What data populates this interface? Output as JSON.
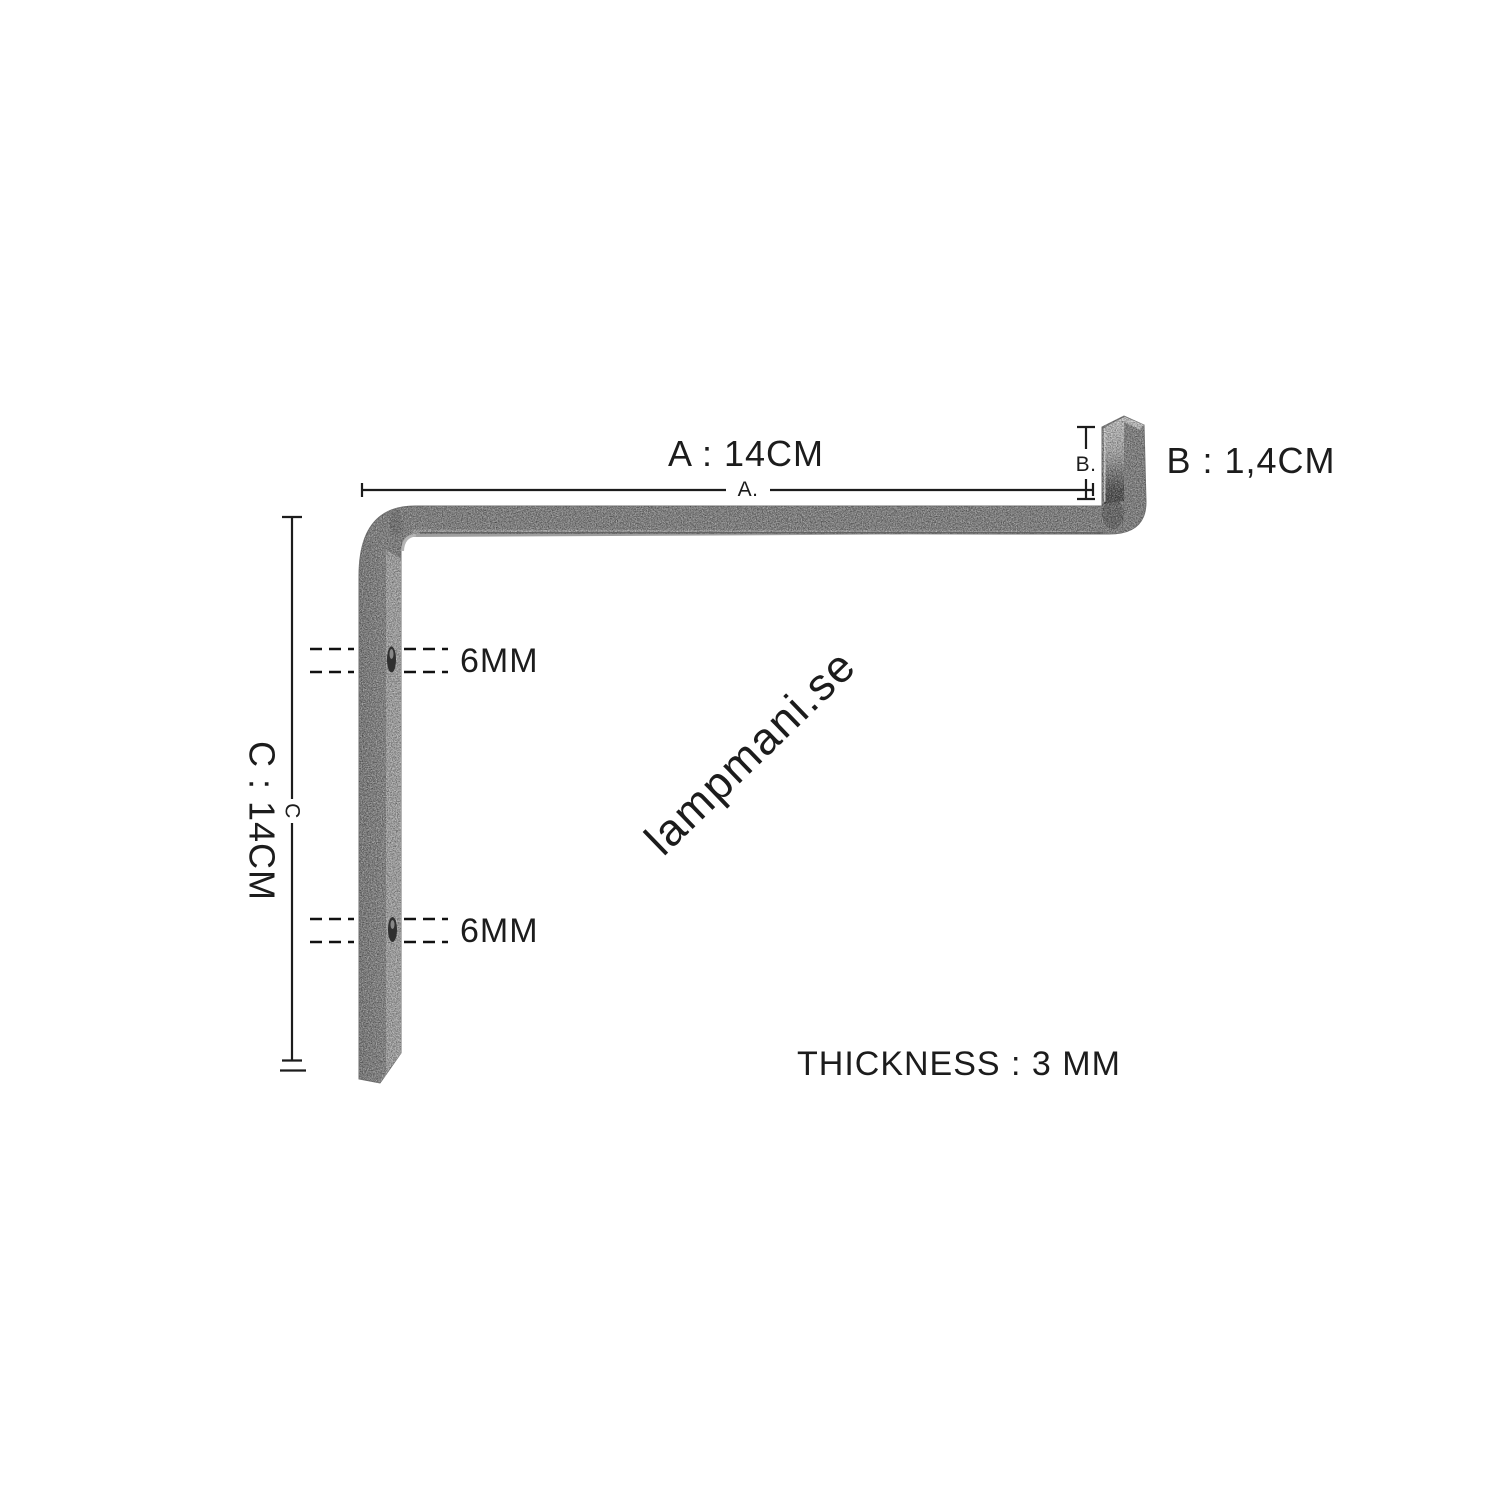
{
  "canvas": {
    "background": "#ffffff"
  },
  "watermark": {
    "text": "lampmani.se",
    "color": "#e7e7e7"
  },
  "diagram": {
    "subject": "flat-steel wall bracket, side view",
    "annotation_color": "#1c1c1c",
    "bracket_colors": {
      "face_dark": "#818181",
      "face_light": "#a7a7a7",
      "under_strip": "#9e9e9e",
      "lip_end_face": "#c8c8c8",
      "hole": "#303030"
    },
    "dimensions": {
      "a": {
        "title": "A : 14CM",
        "line_label": "A."
      },
      "b": {
        "title": "B : 1,4CM",
        "line_label": "B."
      },
      "c": {
        "title": "C : 14CM",
        "line_label": "C"
      },
      "hole_top": {
        "label": "6MM"
      },
      "hole_bottom": {
        "label": "6MM"
      },
      "thickness": {
        "label": "THICKNESS : 3 MM"
      }
    }
  }
}
